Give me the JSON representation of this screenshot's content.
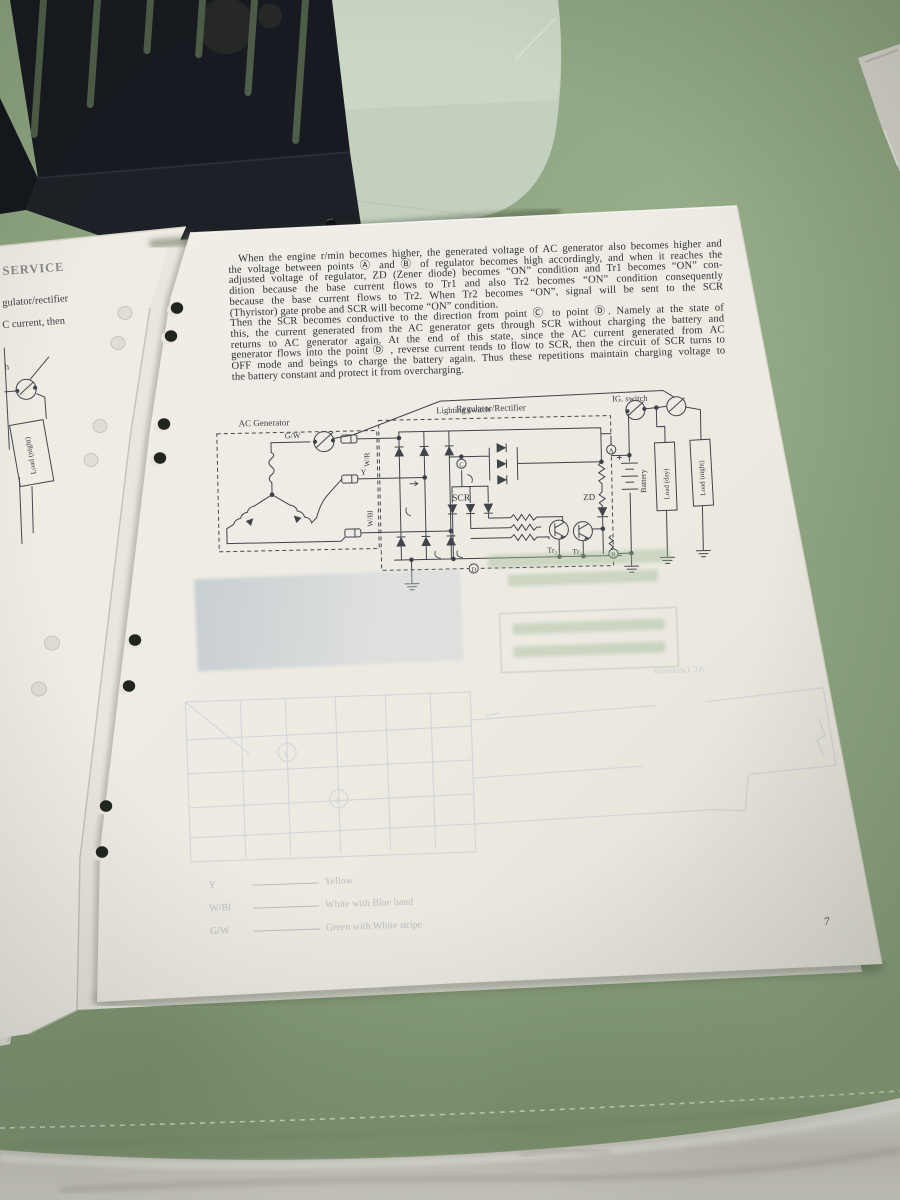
{
  "paragraph": {
    "lines": [
      "When the engine r/min becomes higher, the generated voltage of AC generator also becomes higher and",
      "the voltage between points Ⓐ and Ⓑ of regulator becomes high accordingly, and when it reaches the",
      "adjusted voltage of regulator, ZD (Zener diode) becomes “ON” condition and Tr1 becomes “ON” con-",
      "dition because the base current flows to Tr1 and also Tr2 becomes “ON” condition consequently",
      "because the base current flows to Tr2.  When Tr2 becomes “ON”, signal will be sent to the SCR",
      "(Thyristor) gate probe and SCR will become “ON” condition.",
      "Then the SCR becomes conductive to the direction from point Ⓒ to point Ⓓ.  Namely at the state of",
      "this, the current generated from the AC generator gets through SCR without charging the battery and",
      "returns to AC generator again.  At the end of this state, since the AC current generated from AC",
      "generator flows into the point Ⓓ , reverse current tends to flow to SCR, then the circuit of SCR turns to",
      "OFF mode and beings to charge the battery again.  Thus these repetitions maintain charging voltage to",
      "the battery constant and protect it from overcharging."
    ]
  },
  "diagram": {
    "ac_generator": "AC Generator",
    "gw": "G/W",
    "wr": "W/R",
    "y": "Y",
    "wbl": "W/Bl",
    "lighting_switch": "Lighting switch",
    "regulator": "Regulator/Rectifier",
    "scr": "SCR",
    "zd": "ZD",
    "tr2": "Tr₂",
    "tr1": "Tr₁",
    "ig_switch": "IG. switch",
    "battery": "Battery",
    "load_day": "Load (day)",
    "load_night": "Load (night)",
    "pt_a": "A",
    "pt_b": "B",
    "pt_c": "C",
    "pt_d": "D"
  },
  "page_number": "7",
  "under_page": {
    "frag_title": "SERVICE",
    "frag1": "gulator/rectifier",
    "frag2": "C current, then",
    "frag3": "h",
    "load_night": "Load (night)"
  },
  "show_through": {
    "ac_generator": "AC Generator",
    "y_mark": "Y",
    "legend": [
      {
        "code": "Y",
        "name": "Yellow"
      },
      {
        "code": "W/Bl",
        "name": "White with Blue band"
      },
      {
        "code": "G/W",
        "name": "Green with White stripe"
      }
    ]
  }
}
